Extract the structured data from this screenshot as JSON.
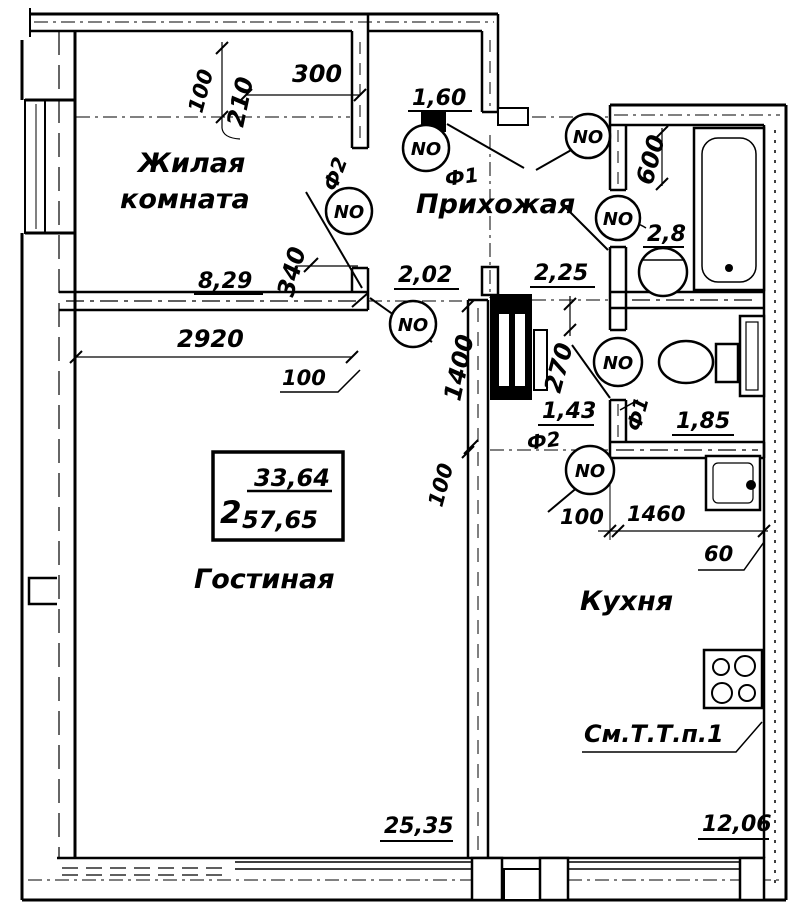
{
  "drawing": {
    "type": "apartment floor plan",
    "colors": {
      "ink": "#000000",
      "paper": "#ffffff"
    }
  },
  "rooms": {
    "zhilaya": {
      "line1": "Жилая",
      "line2": "комната",
      "area": "8,29"
    },
    "prihozhaya": {
      "label": "Прихожая",
      "area": "2,02"
    },
    "corridor": {
      "area": "2,25"
    },
    "vestibule": {
      "area": "1,60"
    },
    "bathroom": {
      "area": "2,8"
    },
    "closet": {
      "area": "1,43"
    },
    "wc": {
      "area": "1,85"
    },
    "gostinaya": {
      "label": "Гостиная",
      "area": "25,35"
    },
    "kuhnya": {
      "label": "Кухня",
      "area": "12,06"
    }
  },
  "stamp": {
    "room_count": "2",
    "living_area": "33,64",
    "total_area": "57,65"
  },
  "note": {
    "kitchen_ref": "См.Т.Т.п.1"
  },
  "dims": {
    "d100a": "100",
    "d210": "210",
    "d300": "300",
    "d340": "340",
    "d2920": "2920",
    "d100b": "100",
    "d1400": "1400",
    "d270": "270",
    "d600": "600",
    "d100c": "100",
    "d100d": "100",
    "d1460": "1460",
    "d60": "60"
  },
  "doors": {
    "no": "NO",
    "f1": "Ф1",
    "f2": "Ф2"
  }
}
